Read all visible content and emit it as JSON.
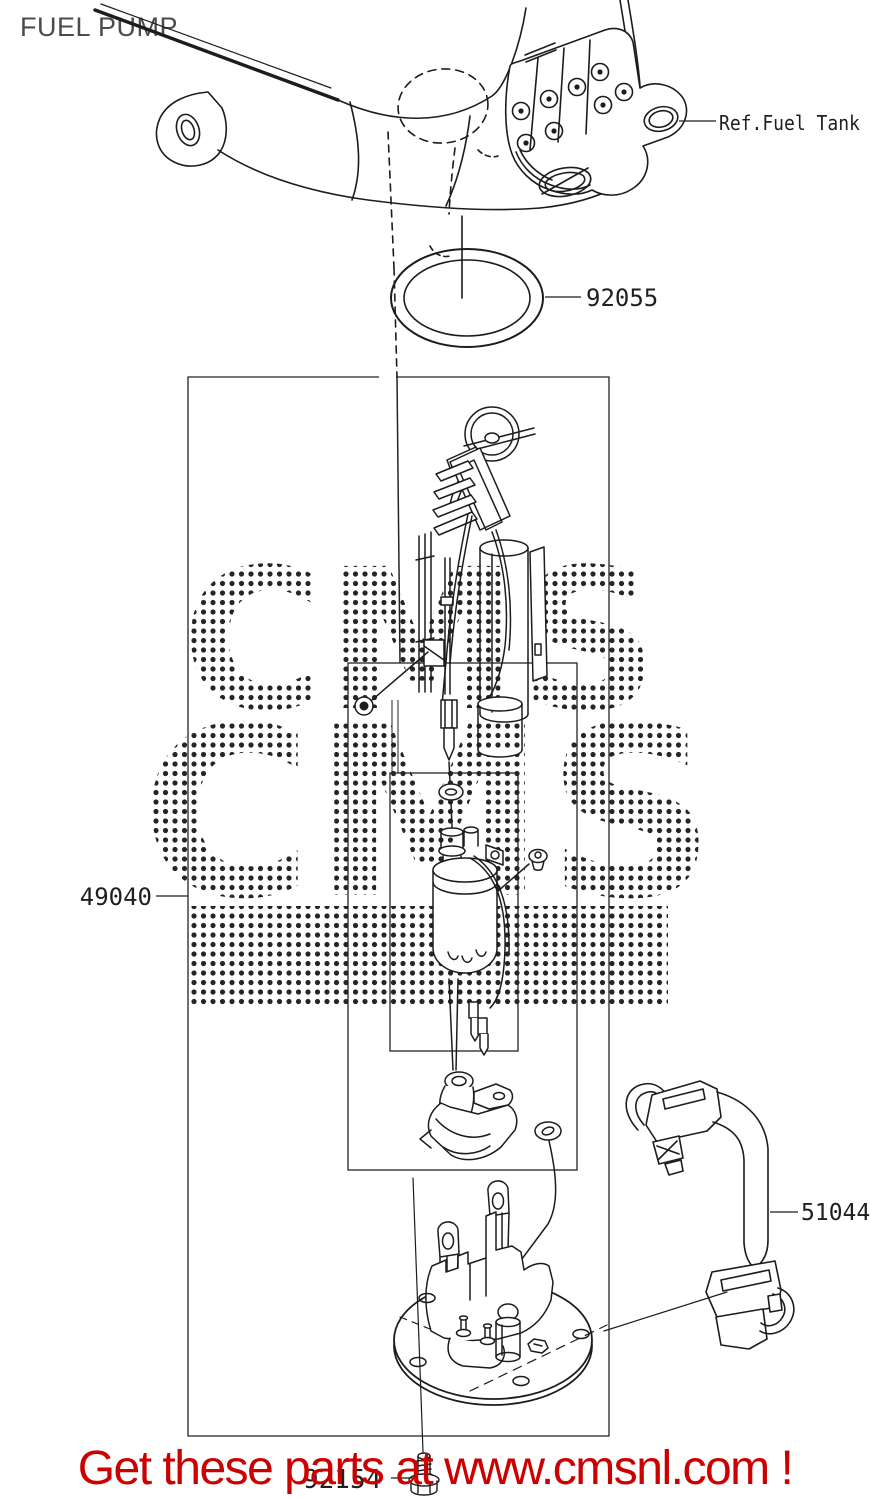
{
  "page": {
    "title": "FUEL PUMP",
    "background": "#ffffff"
  },
  "diagram": {
    "callouts": {
      "ref_fuel_tank": "Ref.Fuel Tank",
      "o_ring": "92055",
      "pump_assembly": "49040",
      "fuel_hose": "51044",
      "bolt": "92154"
    },
    "watermark_text": "CMS",
    "line_color": "#1c1c1c"
  },
  "banner": {
    "text": "Get these parts at www.cmsnl.com !",
    "color": "#cc0000"
  }
}
